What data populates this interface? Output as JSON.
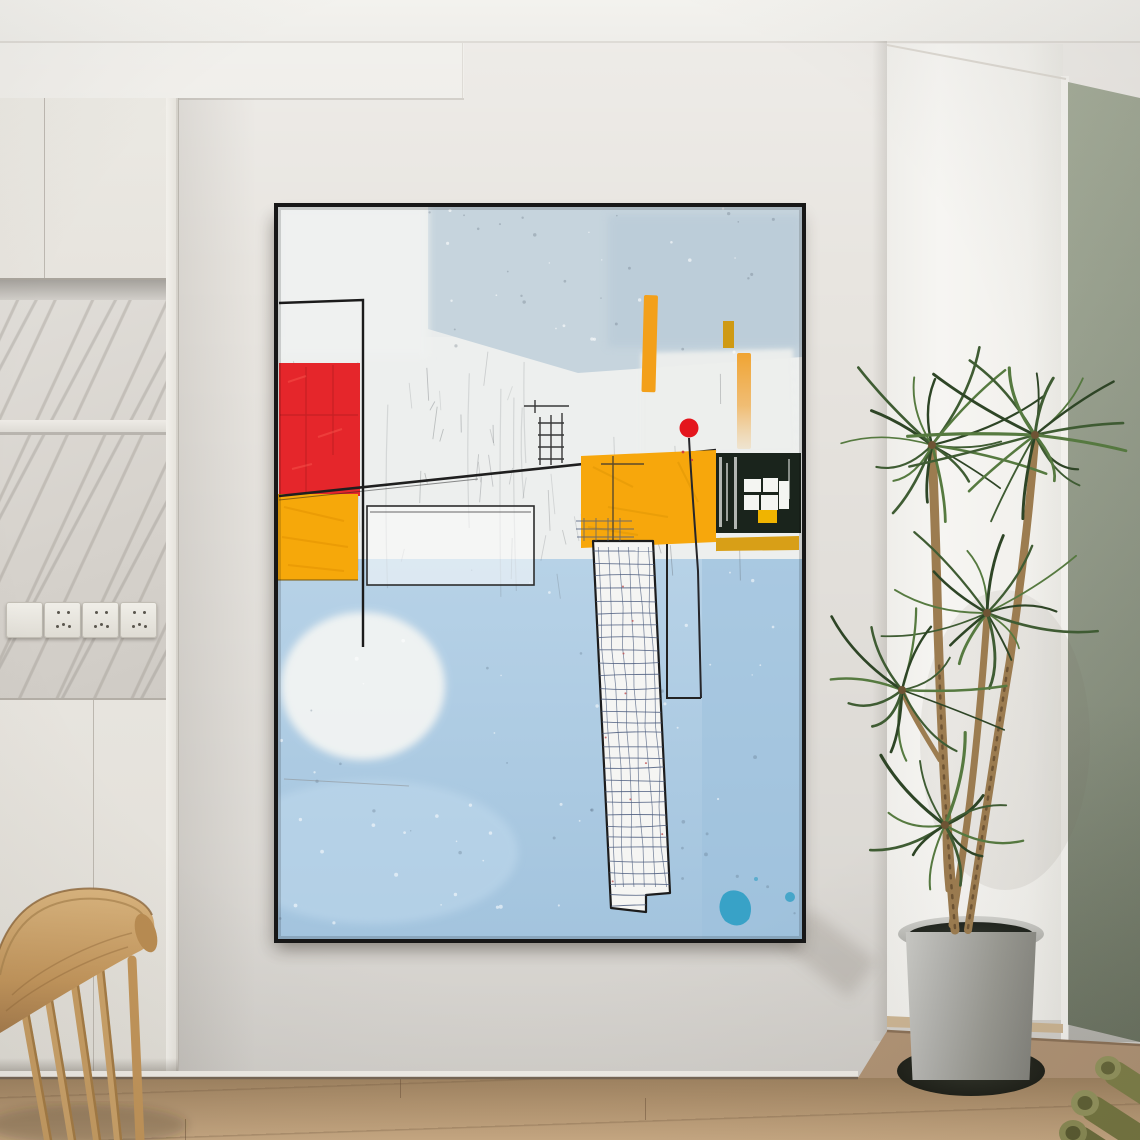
{
  "scene": {
    "description": "Interior photo: abstract framed painting on a light wall, cream cabinetry with marble niche at left, wooden chair bottom-left, dracaena plant in gray pot at right, olive wall panel, green fabric rolls bottom-right, wood floor",
    "objects": [
      {
        "name": "ceiling"
      },
      {
        "name": "upper-cabinet",
        "doors": 2
      },
      {
        "name": "marble-niche",
        "shelves": 1
      },
      {
        "name": "outlet-strip",
        "plates": 4,
        "socket_plates": 3,
        "blank_plates": 1
      },
      {
        "name": "lower-cabinet",
        "doors": 2
      },
      {
        "name": "abstract-painting",
        "frame": "thin black float frame",
        "elements": [
          "red textured block",
          "yellow left block",
          "yellow center block",
          "dark green-black block with white window grid and small yellow square",
          "red dot with long stem line",
          "three orange vertical strokes",
          "white scribbled column",
          "teal paint splash",
          "white blob",
          "sketched rectangles",
          "long slanted black line",
          "light blue lower field"
        ]
      },
      {
        "name": "wooden-chair",
        "spindles": 5
      },
      {
        "name": "wall-corner-column"
      },
      {
        "name": "olive-wall-panel"
      },
      {
        "name": "dracaena-plant",
        "stems": 3,
        "leaf_clusters": 5
      },
      {
        "name": "gray-plant-pot",
        "saucer": "black"
      },
      {
        "name": "green-fabric-rolls",
        "count": 3
      },
      {
        "name": "wood-floor"
      }
    ]
  },
  "palette": {
    "wall": "#e8e5e0",
    "ceiling": "#f3f2ee",
    "frame": "#171717",
    "floor1": "#9e8260",
    "floor2": "#c9aa84",
    "artRed": "#e5262b",
    "artRedDot": "#e4161d",
    "artYellow": "#f7a70c",
    "artYellowLeft": "#f6a80a",
    "artMustard": "#d89f17",
    "artOrangeBar": "#f3a01a",
    "artBlack": "#1a241c",
    "artTeal": "#2f9fc4",
    "artBlueTop": "#c6d4dd",
    "artBlueLow": "#abc9e2",
    "artWhite": "#edefee",
    "artLine": "#222222",
    "artScribble": "#5a6b8c",
    "wood1": "#d9b47e",
    "wood2": "#c3965c",
    "woodDark": "#a2784a",
    "stem": "#9c7c50",
    "stemDark": "#6e5434",
    "leaf1": "#3f5c33",
    "leaf2": "#567a40",
    "leaf3": "#2e4526",
    "roll1": "#7f8049",
    "roll2": "#6c6d3c",
    "rollHi": "#94955e"
  }
}
